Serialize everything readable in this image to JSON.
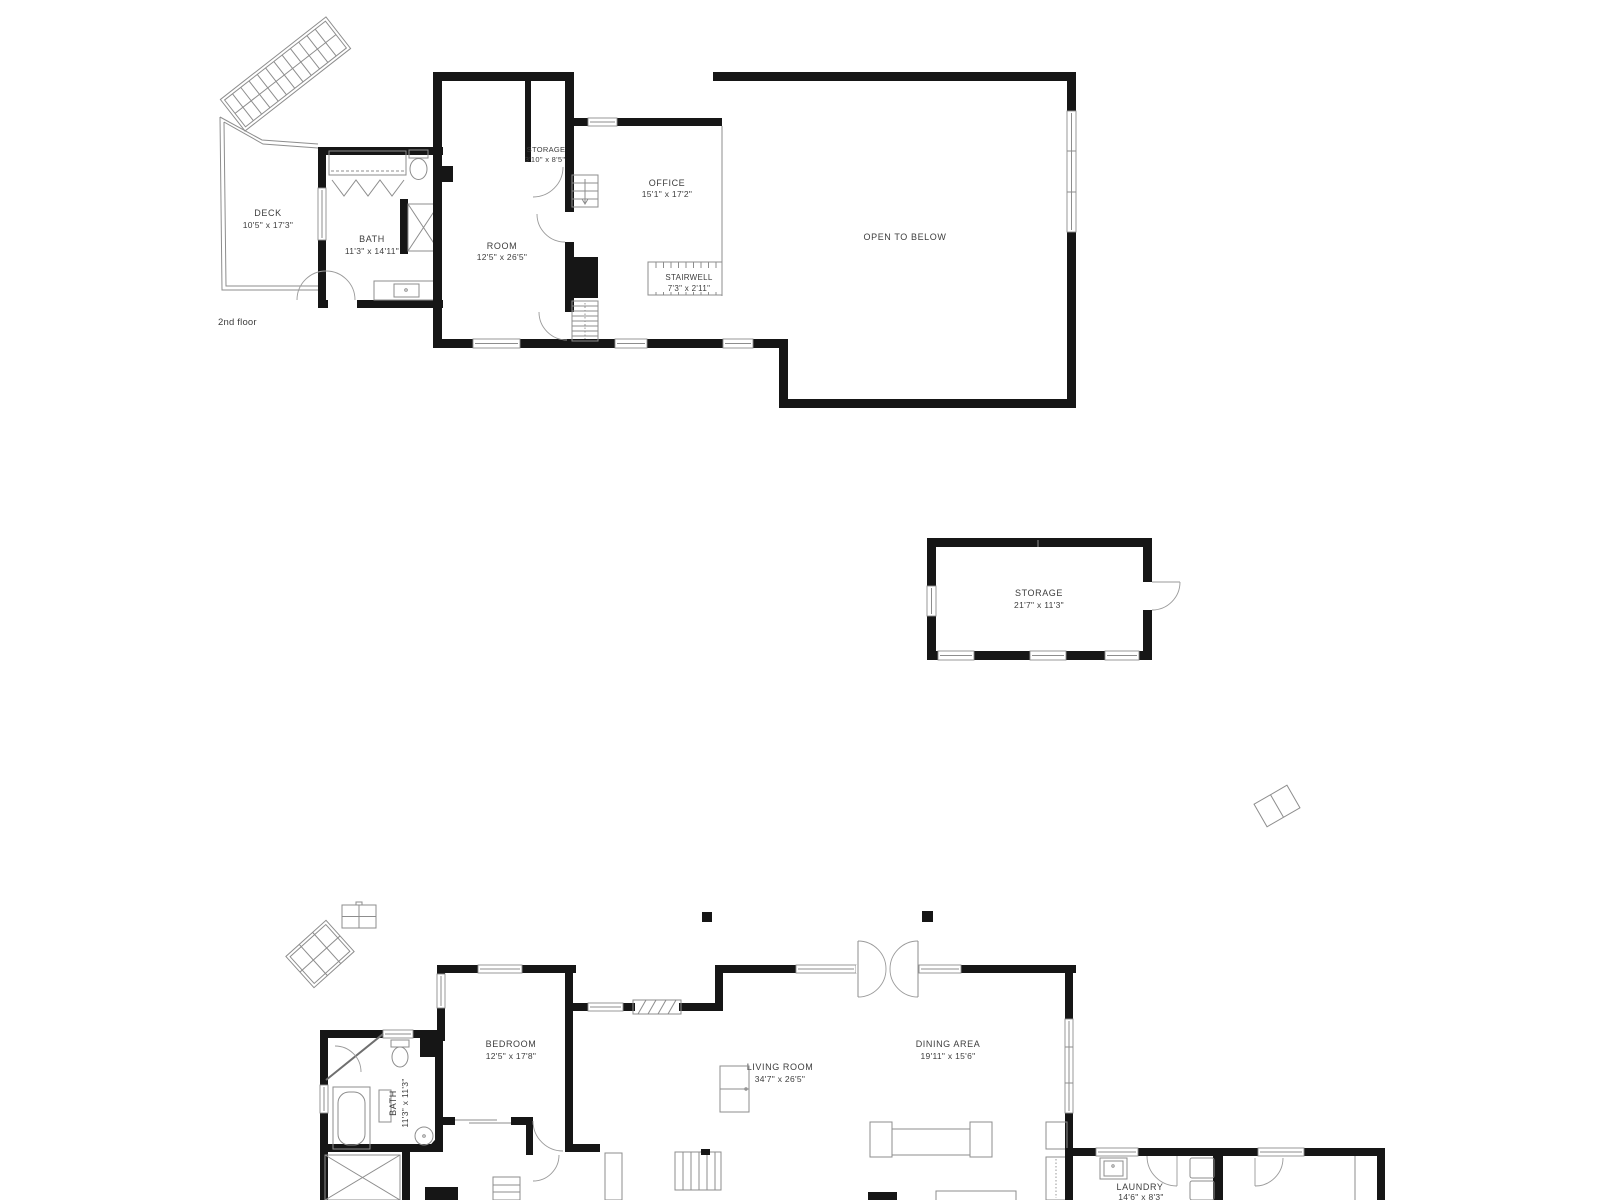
{
  "plan": {
    "background": "#ffffff",
    "wall_color": "#161616",
    "line_color": "#8d8d8d",
    "label_color": "#3d3d3d"
  },
  "second_floor": {
    "floor_label": "2nd floor",
    "rooms": {
      "deck": {
        "name": "DECK",
        "dims": "10'5\" x 17'3\""
      },
      "bath": {
        "name": "BATH",
        "dims": "11'3\" x 14'11\""
      },
      "room": {
        "name": "ROOM",
        "dims": "12'5\" x 26'5\""
      },
      "storage_closet": {
        "name": "STORAGE",
        "dims": "3'10\" x 8'5\""
      },
      "office": {
        "name": "OFFICE",
        "dims": "15'1\" x 17'2\""
      },
      "stairwell": {
        "name": "STAIRWELL",
        "dims": "7'3\" x 2'11\""
      },
      "open_to_below": {
        "name": "OPEN TO BELOW"
      }
    }
  },
  "outbuilding": {
    "rooms": {
      "storage": {
        "name": "STORAGE",
        "dims": "21'7\" x 11'3\""
      }
    }
  },
  "first_floor": {
    "rooms": {
      "bedroom": {
        "name": "BEDROOM",
        "dims": "12'5\" x 17'8\""
      },
      "bath": {
        "name": "BATH",
        "dims": "11'3\" x 11'3\""
      },
      "living_room": {
        "name": "LIVING ROOM",
        "dims": "34'7\" x 26'5\""
      },
      "dining_area": {
        "name": "DINING AREA",
        "dims": "19'11\" x 15'6\""
      },
      "laundry": {
        "name": "LAUNDRY",
        "dims": "14'6\" x 8'3\""
      }
    }
  }
}
